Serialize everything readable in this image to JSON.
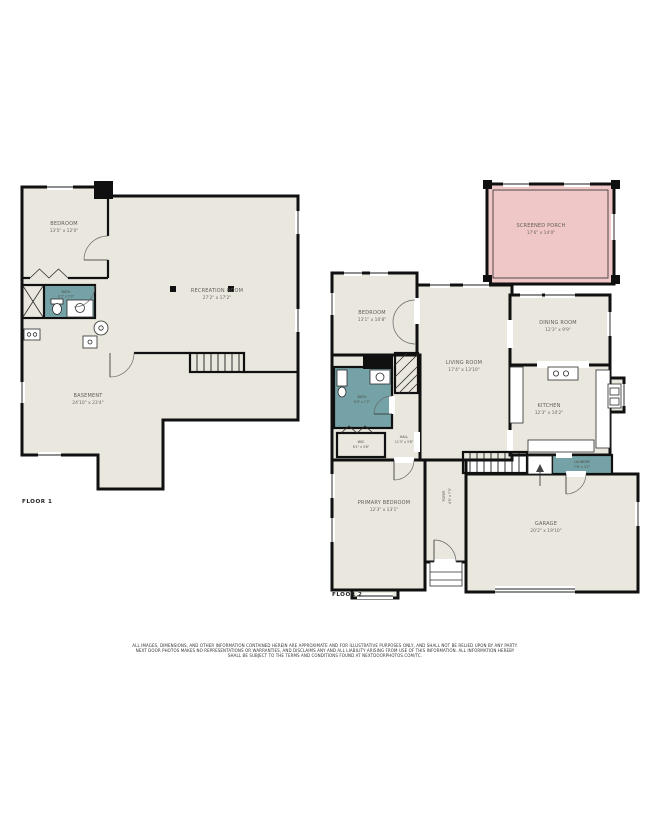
{
  "colors": {
    "room_fill": "#e9e7de",
    "bath_fill": "#74a2a6",
    "porch_fill": "#f0c7c7",
    "wall": "#101010",
    "label": "#5f5e57"
  },
  "floor1": {
    "label": "FLOOR 1",
    "rooms": {
      "bedroom": {
        "name": "BEDROOM",
        "dims": "13'5\" x 12'0\""
      },
      "recreation": {
        "name": "RECREATION ROOM",
        "dims": "27'2\" x 17'2\""
      },
      "bath": {
        "name": "BATH",
        "dims": "8'2\" x 5'0\""
      },
      "basement": {
        "name": "BASEMENT",
        "dims": "24'10\" x 23'4\""
      }
    }
  },
  "floor2": {
    "label": "FLOOR 2",
    "rooms": {
      "screened_porch": {
        "name": "SCREENED PORCH",
        "dims": "17'6\" x 14'0\""
      },
      "bedroom": {
        "name": "BEDROOM",
        "dims": "13'1\" x 10'8\""
      },
      "dining": {
        "name": "DINING ROOM",
        "dims": "12'3\" x 9'9\""
      },
      "living": {
        "name": "LIVING ROOM",
        "dims": "17'4\" x 13'10\""
      },
      "kitchen": {
        "name": "KITCHEN",
        "dims": "12'3\" x 10'2\""
      },
      "bath": {
        "name": "BATH",
        "dims": "8'0\" x 7'2\""
      },
      "hall": {
        "name": "HALL",
        "dims": "11'3\" x 3'8\""
      },
      "wic": {
        "name": "WIC",
        "dims": "6'1\" x 3'6\""
      },
      "primary": {
        "name": "PRIMARY BEDROOM",
        "dims": "12'3\" x 13'1\""
      },
      "foyer": {
        "name": "FOYER",
        "dims": "4'5\" x 7'3\""
      },
      "laundry": {
        "name": "LAUNDRY",
        "dims": "7'6\" x 3'2\""
      },
      "garage": {
        "name": "GARAGE",
        "dims": "20'2\" x 19'10\""
      }
    }
  },
  "disclaimer": {
    "line1": "ALL IMAGES, DIMENSIONS, AND OTHER INFORMATION CONTAINED HEREIN ARE APPROXIMATE AND FOR ILLUSTRATIVE PURPOSES ONLY, AND SHALL NOT BE RELIED UPON BY ANY PARTY.",
    "line2": "NEXT DOOR PHOTOS MAKES NO REPRESENTATIONS OR WARRANTIES, AND DISCLAIMS ANY AND ALL LIABILITY ARISING FROM USE OF THIS INFORMATION. ALL INFORMATION HEREBY",
    "line3": "SHALL BE SUBJECT TO THE TERMS AND CONDITIONS FOUND AT NEXTDOORPHOTOS.COM/TC."
  }
}
